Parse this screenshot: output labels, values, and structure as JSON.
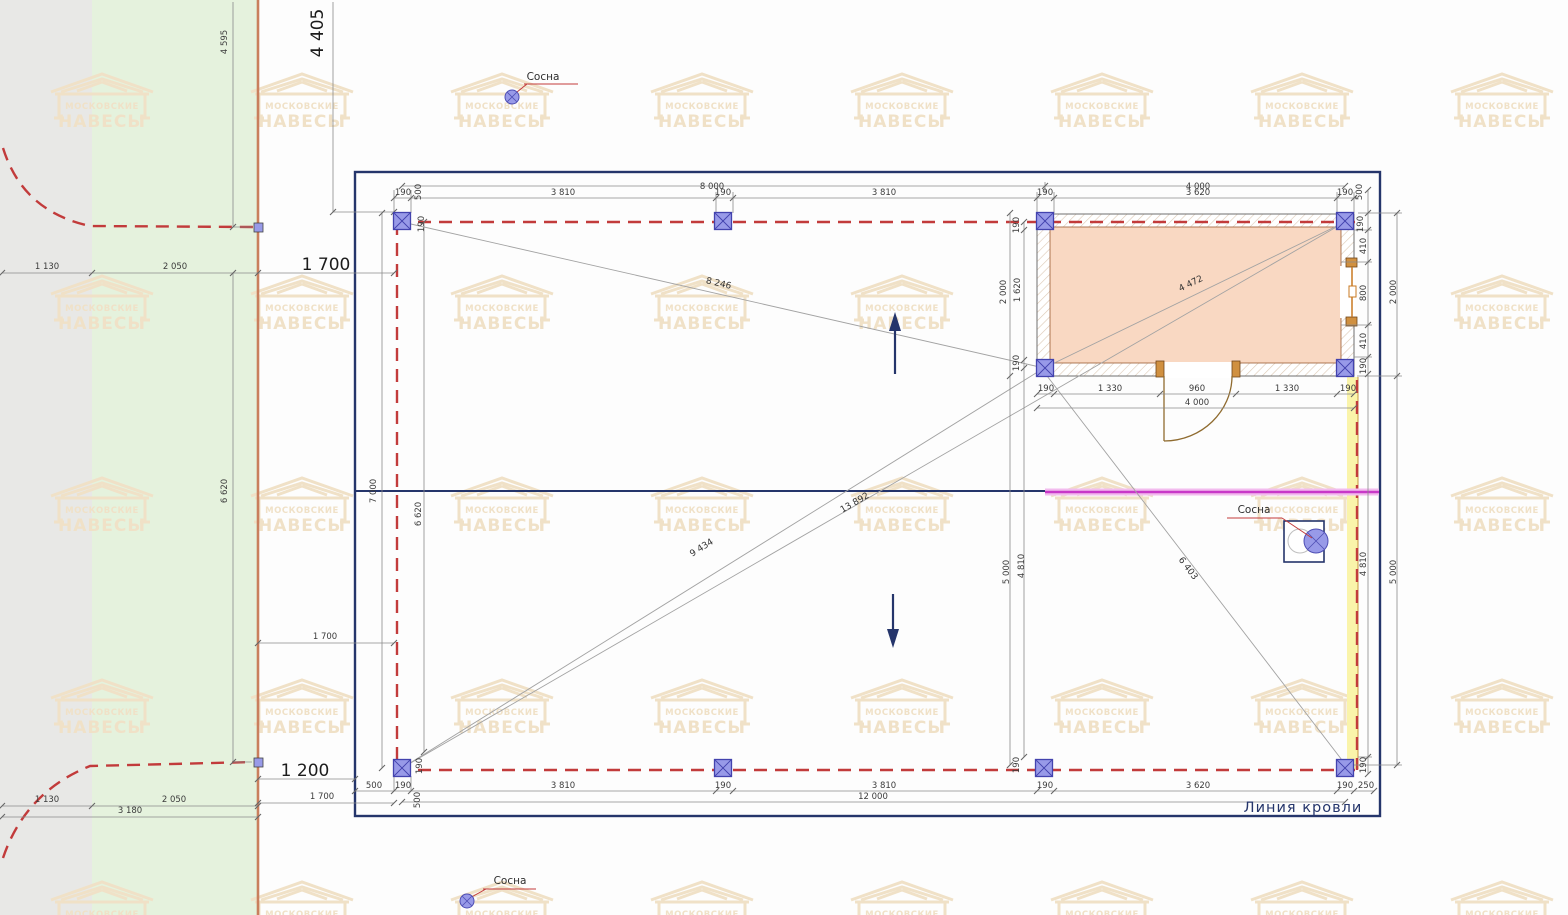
{
  "watermark": {
    "line1": "МОСКОВСКИЕ",
    "line2": "НАВЕСЫ"
  },
  "labels": {
    "sosna": "Сосна",
    "roof_line": "Линия кровли"
  },
  "dims": {
    "n8000": "8 000",
    "n4000": "4 000",
    "n3810": "3 810",
    "n3620": "3 620",
    "n190": "190",
    "n500": "500",
    "n250": "250",
    "n12000": "12 000",
    "n410": "410",
    "n800": "800",
    "n2000": "2 000",
    "n1620": "1 620",
    "n1330": "1 330",
    "n960": "960",
    "n7000": "7 000",
    "n6620": "6 620",
    "n4595": "4 595",
    "n4405": "4 405",
    "n1700": "1 700",
    "n1130": "1 130",
    "n2050": "2 050",
    "n3180": "3 180",
    "n1200": "1 200",
    "n5000": "5 000",
    "n4810": "4 810",
    "d8246": "8 246",
    "d13892": "13 892",
    "d9434": "9 434",
    "d4472": "4 472",
    "d6403": "6 403"
  },
  "colors": {
    "navy": "#25356b",
    "dashRed": "#c23b3b",
    "colFill": "#989ae8",
    "colStroke": "#4343ae",
    "peach": "#f9d8c2",
    "magenta": "#c838c8",
    "magentaHalo": "#f2bcee",
    "yellow": "#faf4aa",
    "boundary": "#c97f5d",
    "grayBand": "#e8e8e6",
    "greenBand": "#e5f2dd",
    "watermark": "#f0e1c7",
    "dimGray": "#8a8a8a",
    "wood": "#c87820"
  }
}
